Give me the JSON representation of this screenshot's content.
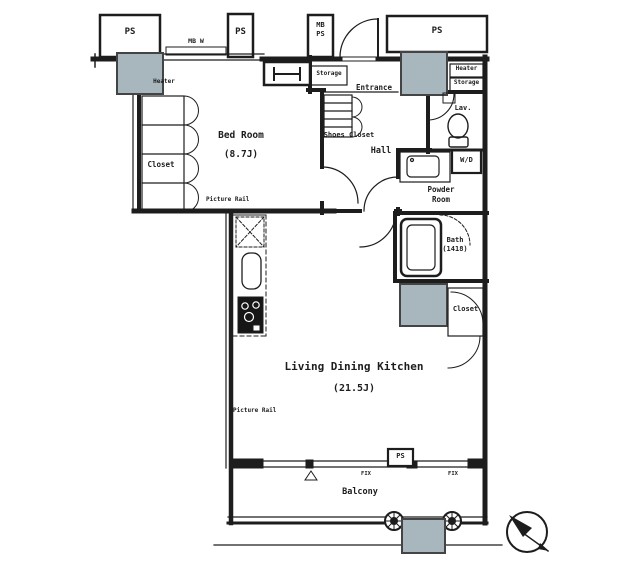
{
  "plan": {
    "title": "1LDK apartment floor plan",
    "rooms": {
      "bedroom_name": "Bed Room",
      "bedroom_size": "(8.7J)",
      "ldk_name": "Living Dining Kitchen",
      "ldk_size": "(21.5J)",
      "balcony": "Balcony",
      "entrance": "Entrance",
      "hall": "Hall",
      "shoes_closet": "Shoes Closet",
      "powder_line1": "Powder",
      "powder_line2": "Room",
      "bath_line1": "Bath",
      "bath_line2": "(1418)",
      "lav": "Lav.",
      "wd": "W/D",
      "closet_left": "Closet",
      "closet_right": "Closet",
      "storage_left": "Storage",
      "storage_right": "Storage",
      "heater_left": "Heater",
      "heater_right": "Heater"
    },
    "service": {
      "ps1": "PS",
      "ps2": "PS",
      "ps3": "PS",
      "ps4": "PS",
      "mb_line1": "MB",
      "mb_line2": "PS",
      "mb_w": "MB W",
      "fix1": "FIX",
      "fix2": "FIX",
      "picture_rail_top": "Picture Rail",
      "picture_rail_left": "Picture Rail"
    },
    "colors": {
      "pillar": "#a8b6be",
      "line": "#1d1d1d"
    }
  }
}
